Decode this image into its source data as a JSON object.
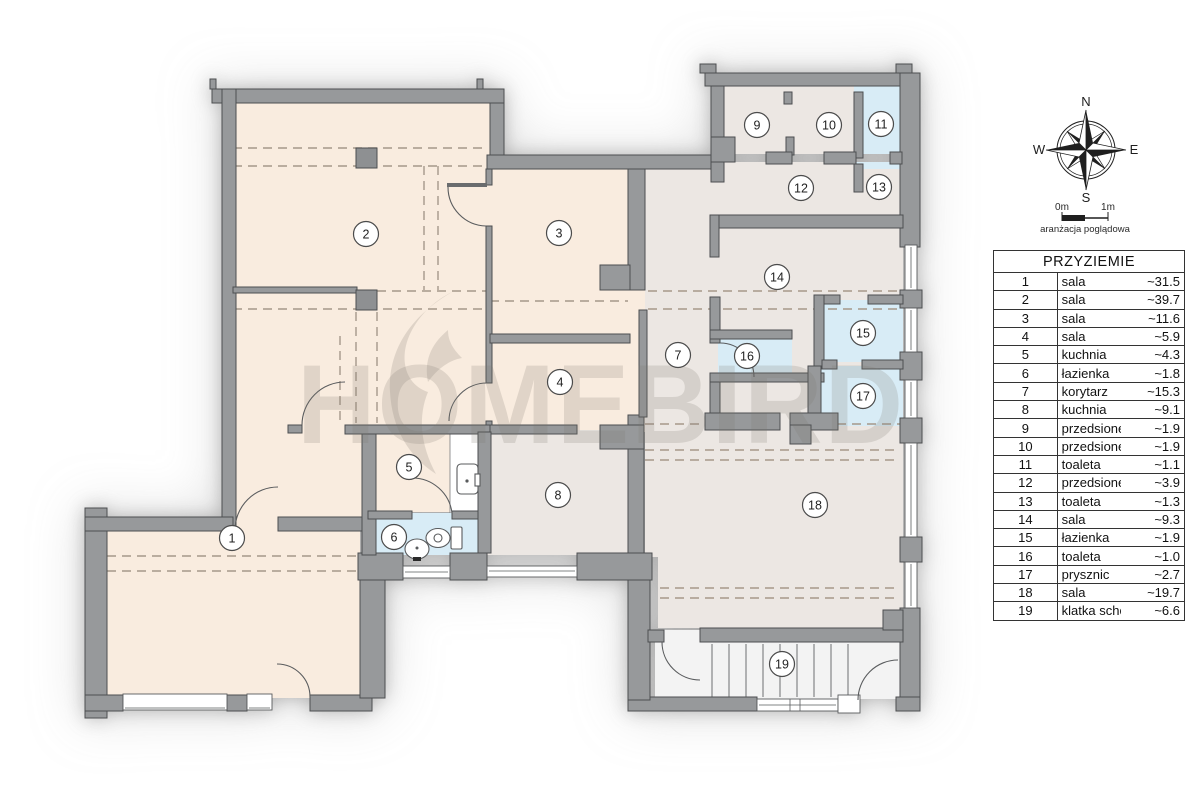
{
  "watermark": {
    "text": "HOMEBIRD"
  },
  "legend": {
    "title": "PRZYZIEMIE",
    "rows": [
      {
        "num": "1",
        "name": "sala",
        "area": "~31.5"
      },
      {
        "num": "2",
        "name": "sala",
        "area": "~39.7"
      },
      {
        "num": "3",
        "name": "sala",
        "area": "~11.6"
      },
      {
        "num": "4",
        "name": "sala",
        "area": "~5.9"
      },
      {
        "num": "5",
        "name": "kuchnia",
        "area": "~4.3"
      },
      {
        "num": "6",
        "name": "łazienka",
        "area": "~1.8"
      },
      {
        "num": "7",
        "name": "korytarz",
        "area": "~15.3"
      },
      {
        "num": "8",
        "name": "kuchnia",
        "area": "~9.1"
      },
      {
        "num": "9",
        "name": "przedsionek",
        "area": "~1.9"
      },
      {
        "num": "10",
        "name": "przedsionek",
        "area": "~1.9"
      },
      {
        "num": "11",
        "name": "toaleta",
        "area": "~1.1"
      },
      {
        "num": "12",
        "name": "przedsionek",
        "area": "~3.9"
      },
      {
        "num": "13",
        "name": "toaleta",
        "area": "~1.3"
      },
      {
        "num": "14",
        "name": "sala",
        "area": "~9.3"
      },
      {
        "num": "15",
        "name": "łazienka",
        "area": "~1.9"
      },
      {
        "num": "16",
        "name": "toaleta",
        "area": "~1.0"
      },
      {
        "num": "17",
        "name": "prysznic",
        "area": "~2.7"
      },
      {
        "num": "18",
        "name": "sala",
        "area": "~19.7"
      },
      {
        "num": "19",
        "name": "klatka schodowa",
        "area": "~6.6"
      }
    ]
  },
  "compass": {
    "n": "N",
    "e": "E",
    "s": "S",
    "w": "W"
  },
  "scalebar": {
    "left_label": "0m",
    "right_label": "1m",
    "caption": "aranżacja poglądowa"
  },
  "plan": {
    "rooms": [
      {
        "num": "1",
        "x": 232,
        "y": 538
      },
      {
        "num": "2",
        "x": 366,
        "y": 234
      },
      {
        "num": "3",
        "x": 559,
        "y": 233
      },
      {
        "num": "4",
        "x": 560,
        "y": 382
      },
      {
        "num": "5",
        "x": 409,
        "y": 467
      },
      {
        "num": "6",
        "x": 394,
        "y": 537
      },
      {
        "num": "7",
        "x": 678,
        "y": 355
      },
      {
        "num": "8",
        "x": 558,
        "y": 495
      },
      {
        "num": "9",
        "x": 757,
        "y": 125
      },
      {
        "num": "10",
        "x": 829,
        "y": 125
      },
      {
        "num": "11",
        "x": 881,
        "y": 124
      },
      {
        "num": "12",
        "x": 801,
        "y": 188
      },
      {
        "num": "13",
        "x": 879,
        "y": 187
      },
      {
        "num": "14",
        "x": 777,
        "y": 277
      },
      {
        "num": "15",
        "x": 863,
        "y": 333
      },
      {
        "num": "16",
        "x": 747,
        "y": 356
      },
      {
        "num": "17",
        "x": 863,
        "y": 396
      },
      {
        "num": "18",
        "x": 815,
        "y": 505
      },
      {
        "num": "19",
        "x": 782,
        "y": 664
      }
    ],
    "colors": {
      "wall": "#97999b",
      "room_warm": "#f9ecdf",
      "room_cool": "#ece7e3",
      "room_wet": "#d8ecf6",
      "room_stairs": "#f3f3f3",
      "dash": "#a6988a"
    }
  }
}
